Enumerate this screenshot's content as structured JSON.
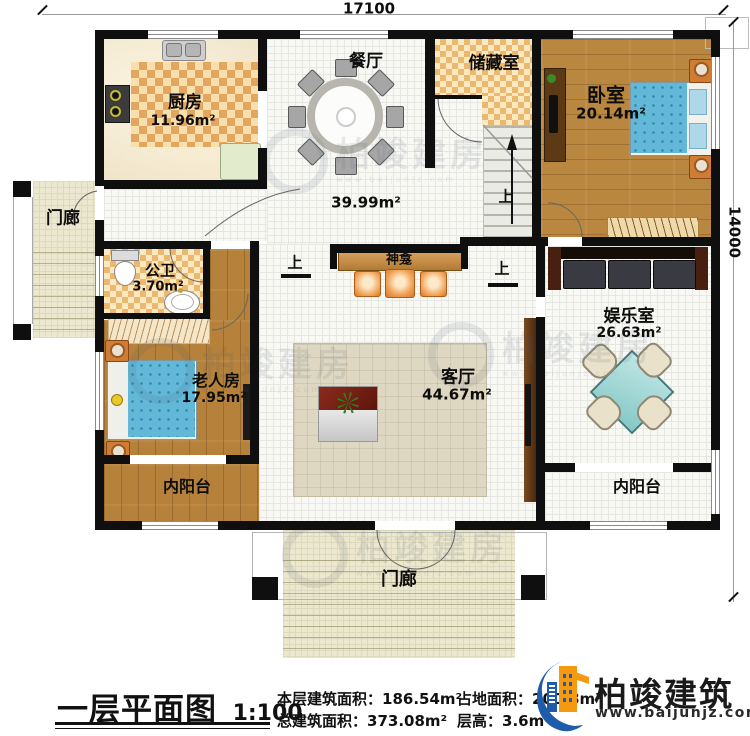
{
  "dimensions": {
    "top": "17100",
    "right": "14000"
  },
  "rooms": {
    "kitchen": {
      "name": "厨房",
      "area": "11.96m²"
    },
    "dining": {
      "name": "餐厅"
    },
    "hall": {
      "area": "39.99m²"
    },
    "storage": {
      "name": "储藏室"
    },
    "bedroom": {
      "name": "卧室",
      "area": "20.14m²"
    },
    "bathroom": {
      "name": "公卫",
      "area": "3.70m²"
    },
    "elder_room": {
      "name": "老人房",
      "area": "17.95m²"
    },
    "living_room": {
      "name": "客厅",
      "area": "44.67m²"
    },
    "shrine": {
      "name": "神龛"
    },
    "entertainment": {
      "name": "娱乐室",
      "area": "26.63m²"
    },
    "balcony_left": {
      "name": "内阳台"
    },
    "balcony_right": {
      "name": "内阳台"
    },
    "porch_left": {
      "name": "门廊"
    },
    "porch_bottom": {
      "name": "门廊"
    }
  },
  "annotations": {
    "up_stairs": "上",
    "up_left": "上",
    "up_right": "上"
  },
  "title_block": {
    "title": "一层平面图",
    "scale": "1:100",
    "stats": [
      {
        "label": "本层建筑面积：",
        "value": "186.54m²"
      },
      {
        "label": "总建筑面积：",
        "value": "373.08m²"
      },
      {
        "label": "占地面积：",
        "value": "200.8m²"
      },
      {
        "label": "层高：",
        "value": "3.6m"
      }
    ]
  },
  "brand": {
    "name": "柏竣建筑",
    "website": "www.baijunjz.com"
  },
  "watermark": {
    "text": "柏竣建房",
    "subtext": "www.baijunjz.com"
  },
  "colors": {
    "brand_blue": "#1e5caa",
    "brand_orange": "#f59a10",
    "wall": "#0f0f0f"
  }
}
